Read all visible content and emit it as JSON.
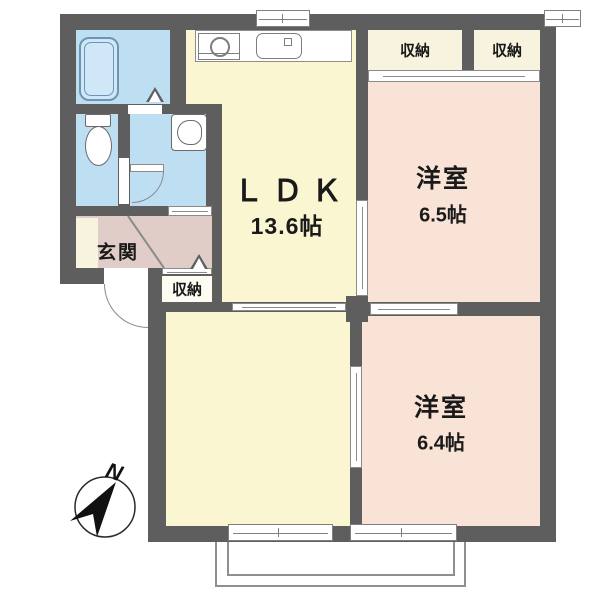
{
  "rooms": {
    "ldk": {
      "name": "ＬＤＫ",
      "size": "13.6帖"
    },
    "western1": {
      "name": "洋室",
      "size": "6.5帖"
    },
    "western2": {
      "name": "洋室",
      "size": "6.4帖"
    },
    "entrance": {
      "name": "玄関"
    }
  },
  "closets": {
    "top_left": "収納",
    "top_right": "収納",
    "entrance": "収納"
  },
  "compass": {
    "north": "N"
  },
  "colors": {
    "wall": "#5E5E5E",
    "room_yellow": "#FAF6D1",
    "room_pink": "#F8E3D6",
    "water_blue": "#BEDFF2",
    "closet_cream": "#F8F3DE",
    "entrance_mauve": "#E1CDC7",
    "line_gray": "#8A8A8A"
  }
}
